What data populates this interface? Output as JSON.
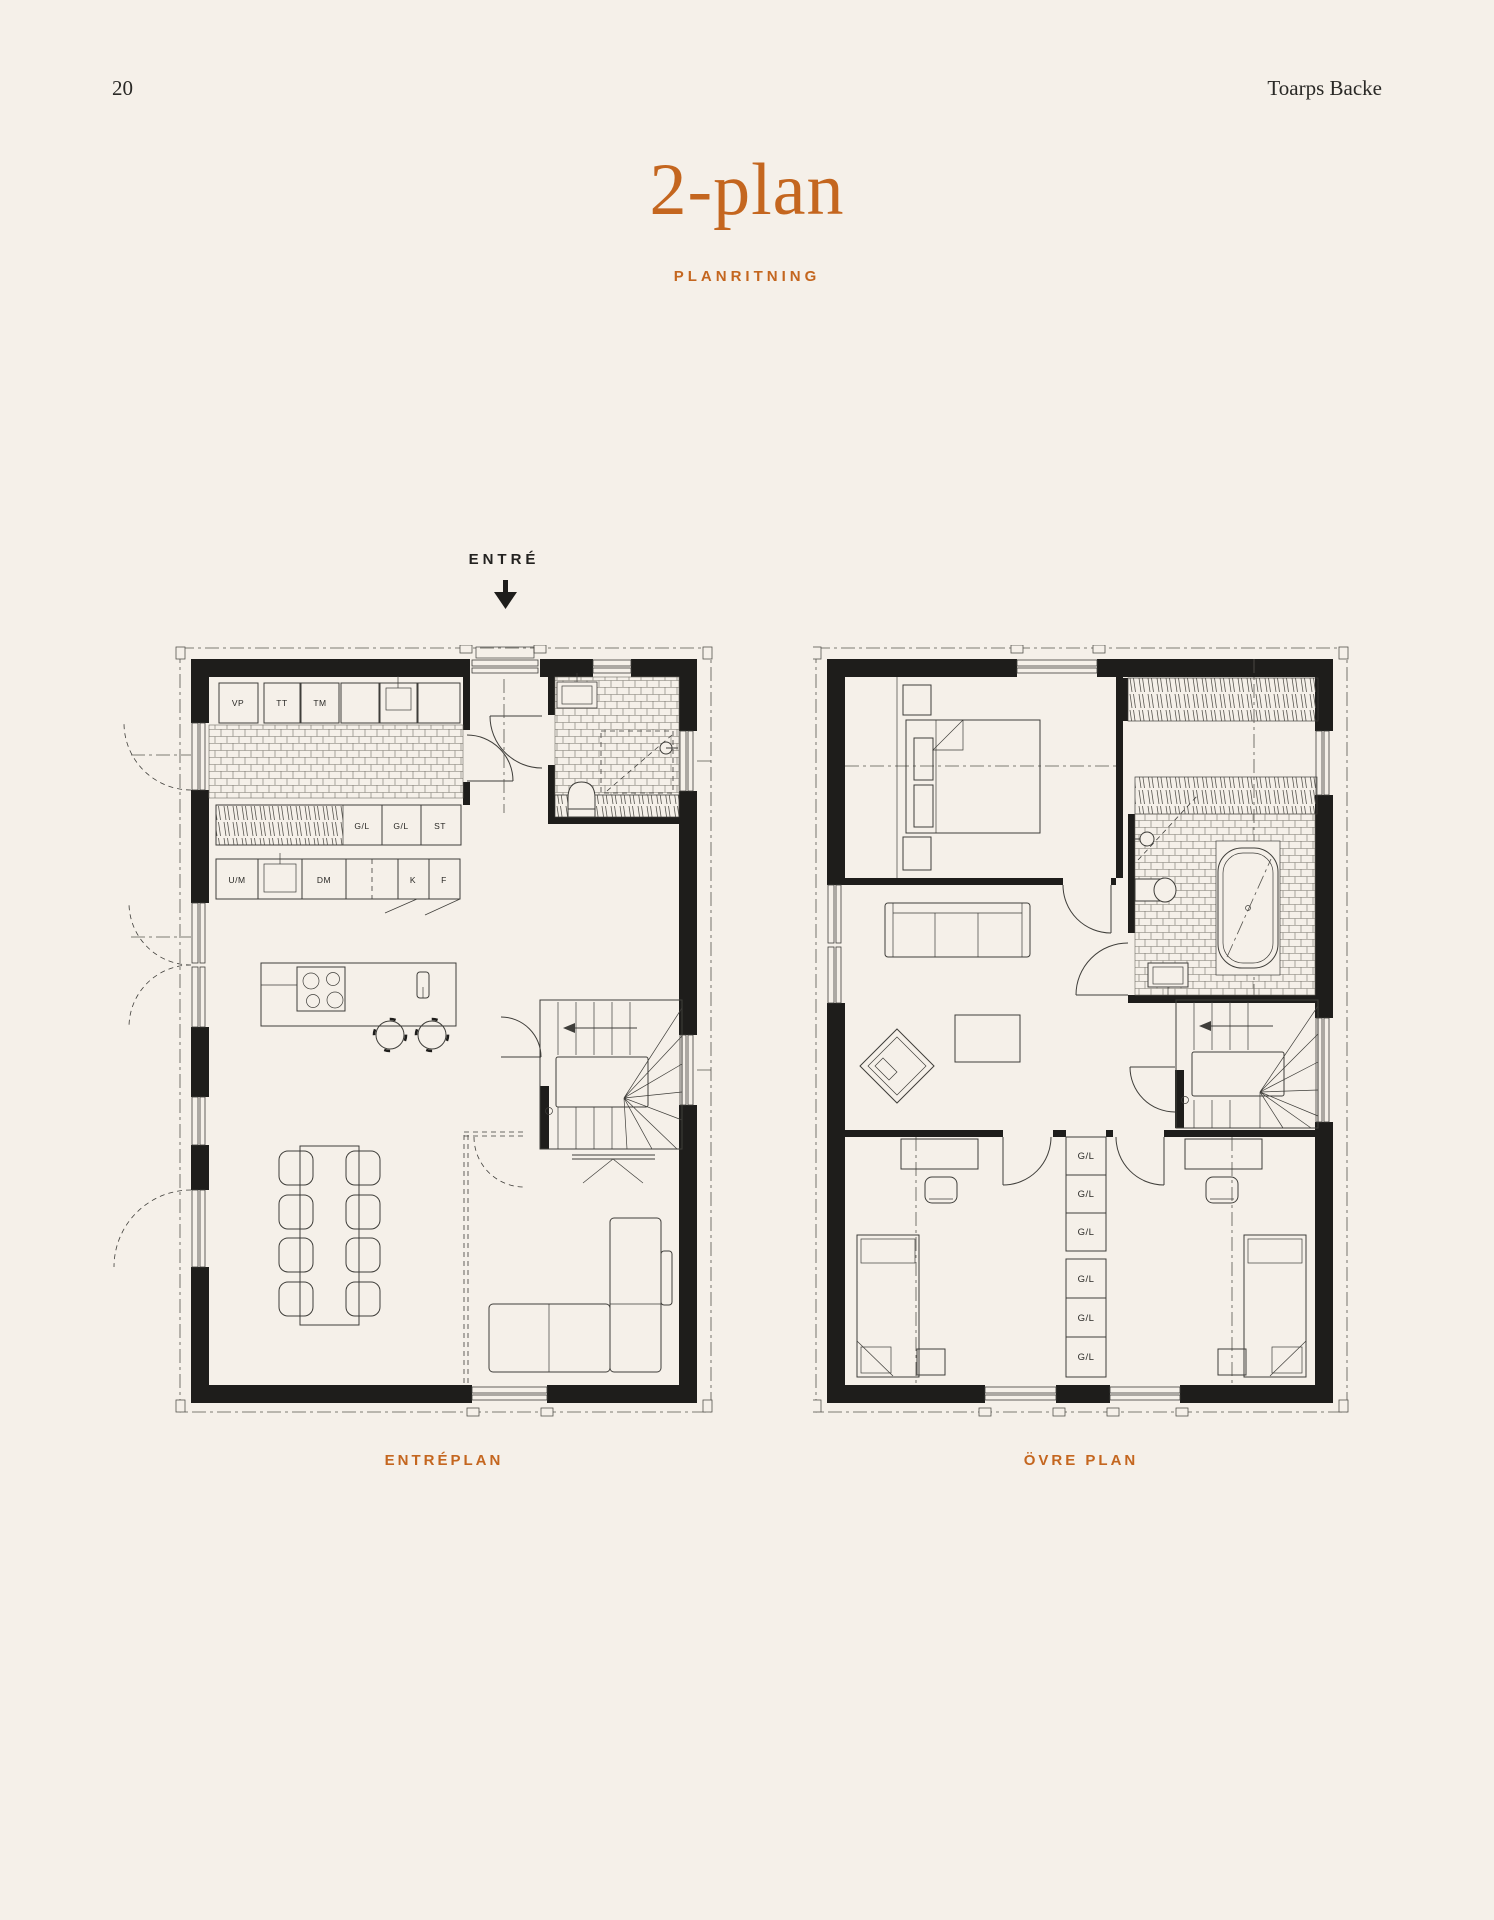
{
  "page": {
    "number": "20",
    "brand": "Toarps Backe",
    "title": "2-plan",
    "subtitle": "PLANRITNING"
  },
  "colors": {
    "background": "#f5f0e9",
    "accent": "#c4661f",
    "wall": "#1e1d1b",
    "line": "#3f3e3a"
  },
  "entrance": {
    "label": "ENTRÉ"
  },
  "plans": [
    {
      "caption": "ENTRÉPLAN",
      "labels": {
        "vp": "VP",
        "tt": "TT",
        "tm": "TM",
        "gl_a": "G/L",
        "gl_b": "G/L",
        "st": "ST",
        "um": "U/M",
        "dm": "DM",
        "k": "K",
        "f": "F"
      }
    },
    {
      "caption": "ÖVRE PLAN",
      "closet_labels": [
        "G/L",
        "G/L",
        "G/L",
        "G/L",
        "G/L",
        "G/L"
      ]
    }
  ]
}
